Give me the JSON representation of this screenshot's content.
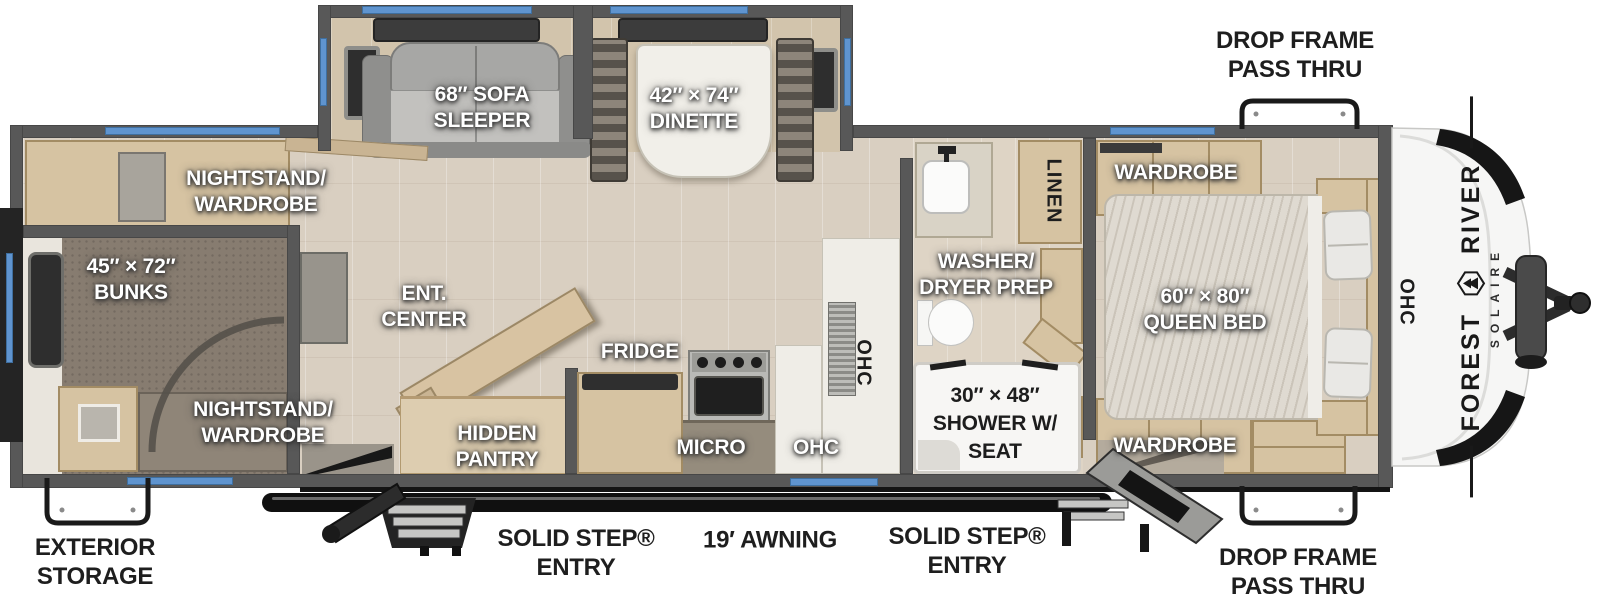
{
  "title": "Forest River Solaire travel trailer floorplan",
  "brand": {
    "maker_first": "FOREST",
    "maker_second": "RIVER",
    "model": "SOLAIRE"
  },
  "exterior_labels": {
    "drop_frame_top": {
      "line1": "DROP FRAME",
      "line2": "PASS THRU"
    },
    "drop_frame_bottom": {
      "line1": "DROP FRAME",
      "line2": "PASS THRU"
    },
    "exterior_storage": {
      "line1": "EXTERIOR",
      "line2": "STORAGE"
    },
    "entry_left": {
      "line1": "SOLID STEP®",
      "line2": "ENTRY"
    },
    "entry_right": {
      "line1": "SOLID STEP®",
      "line2": "ENTRY"
    },
    "awning": "19′ AWNING"
  },
  "room_labels": {
    "sofa": {
      "line1": "68″ SOFA",
      "line2": "SLEEPER"
    },
    "dinette": {
      "line1": "42″ × 74″",
      "line2": "DINETTE"
    },
    "nightstand_top": {
      "line1": "NIGHTSTAND/",
      "line2": "WARDROBE"
    },
    "nightstand_bottom": {
      "line1": "NIGHTSTAND/",
      "line2": "WARDROBE"
    },
    "bunks": {
      "line1": "45″ × 72″",
      "line2": "BUNKS"
    },
    "ent_center": {
      "line1": "ENT.",
      "line2": "CENTER"
    },
    "hidden_pantry": {
      "line1": "HIDDEN",
      "line2": "PANTRY"
    },
    "fridge": "FRIDGE",
    "micro": "MICRO",
    "ohc_kitchen": "OHC",
    "ohc_counter_vertical": "OHC",
    "ohc_front_vertical": "OHC",
    "linen_vertical": "LINEN",
    "washer_dryer": {
      "line1": "WASHER/",
      "line2": "DRYER PREP"
    },
    "shower": {
      "line1": "30″ × 48″",
      "line2": "SHOWER W/",
      "line3": "SEAT"
    },
    "wardrobe_top": "WARDROBE",
    "wardrobe_bottom": "WARDROBE",
    "queen_bed": {
      "line1": "60″ × 80″",
      "line2": "QUEEN BED"
    }
  },
  "colors": {
    "wall": "#585858",
    "window_blue": "#5f94cf",
    "floor_wood": "#d9cfc1",
    "carpet": "#877c70",
    "cabinet_wood": "#d6c3a2",
    "awning_black": "#101010",
    "label_white": "#ffffff",
    "label_black": "#1d1d1d"
  }
}
